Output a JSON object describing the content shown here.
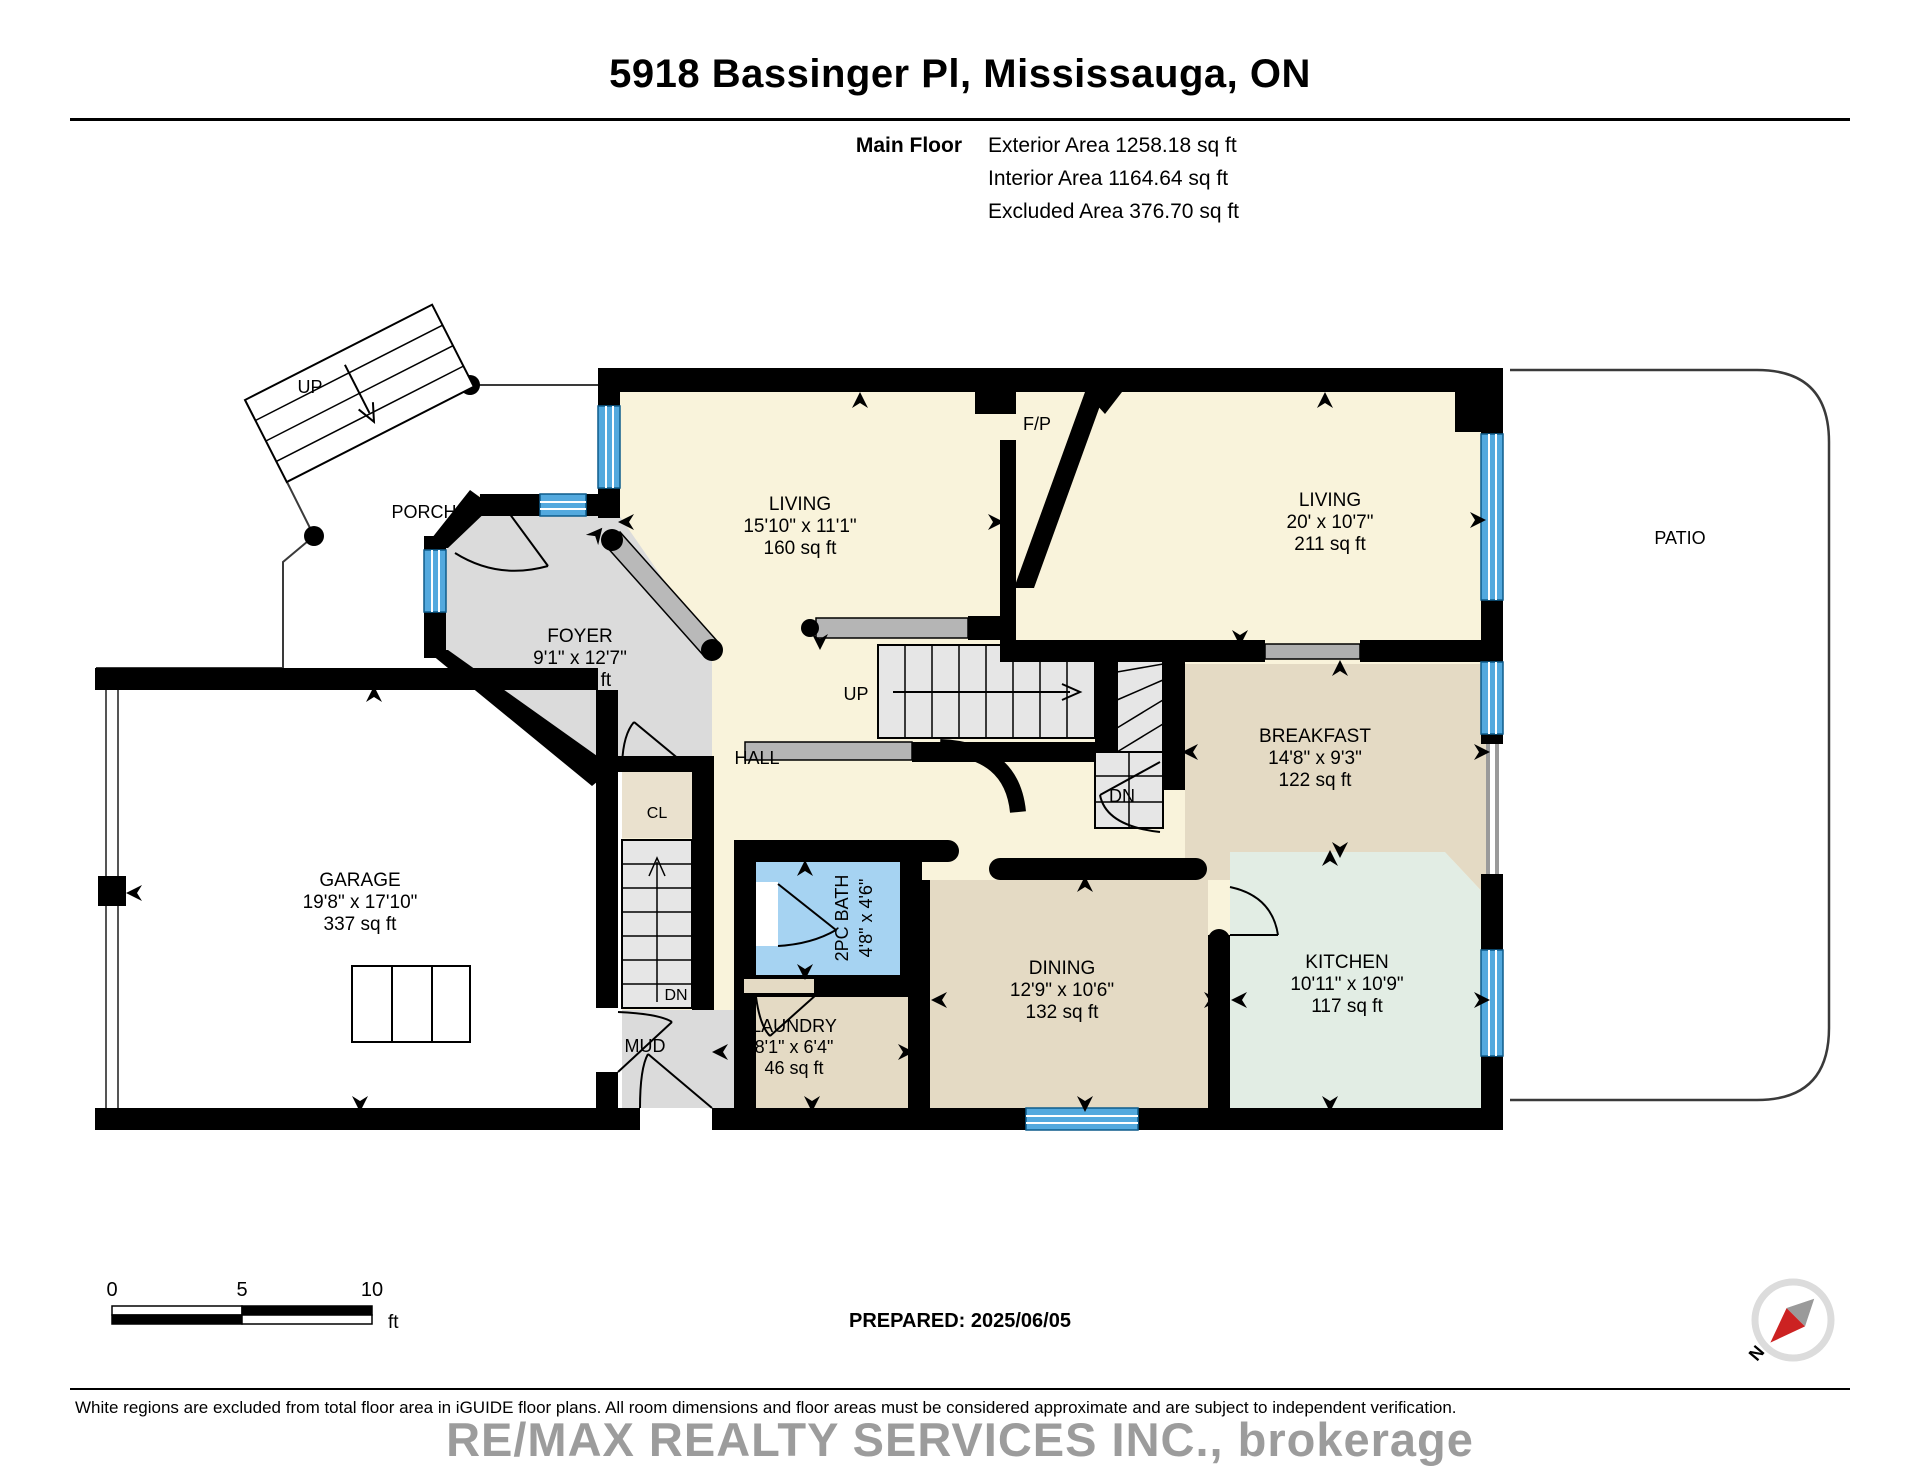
{
  "header": {
    "title": "5918 Bassinger Pl, Mississauga, ON",
    "floor_label": "Main Floor",
    "exterior": "Exterior Area 1258.18 sq ft",
    "interior": "Interior Area 1164.64 sq ft",
    "excluded": "Excluded Area 376.70 sq ft"
  },
  "rooms": {
    "living1": {
      "name": "LIVING",
      "dims": "15'10\" x 11'1\"",
      "area": "160 sq ft"
    },
    "living2": {
      "name": "LIVING",
      "dims": "20' x 10'7\"",
      "area": "211 sq ft"
    },
    "breakfast": {
      "name": "BREAKFAST",
      "dims": "14'8\" x 9'3\"",
      "area": "122 sq ft"
    },
    "kitchen": {
      "name": "KITCHEN",
      "dims": "10'11\" x 10'9\"",
      "area": "117 sq ft"
    },
    "dining": {
      "name": "DINING",
      "dims": "12'9\" x 10'6\"",
      "area": "132 sq ft"
    },
    "laundry": {
      "name": "LAUNDRY",
      "dims": "8'1\" x 6'4\"",
      "area": "46 sq ft"
    },
    "garage": {
      "name": "GARAGE",
      "dims": "19'8\" x 17'10\"",
      "area": "337 sq ft"
    },
    "foyer": {
      "name": "FOYER",
      "dims": "9'1\" x 12'7\"",
      "area": "76 sq ft"
    },
    "bath": {
      "name": "2PC BATH",
      "dims": "4'8\" x 4'6\""
    }
  },
  "labels": {
    "porch": "PORCH",
    "patio": "PATIO",
    "hall": "HALL",
    "mud": "MUD",
    "closet": "CL",
    "fireplace": "F/P",
    "up_porch": "UP",
    "up_stairs": "UP",
    "dn_basement": "DN",
    "dn_breakfast": "DN",
    "north": "N"
  },
  "scale_bar": {
    "zero": "0",
    "five": "5",
    "ten": "10",
    "unit": "ft"
  },
  "footer": {
    "prepared": "PREPARED: 2025/06/05",
    "disclaimer": "White regions are excluded from total floor area in iGUIDE floor plans. All room dimensions and floor areas must be considered approximate and are subject to independent verification.",
    "watermark": "RE/MAX REALTY SERVICES INC., brokerage"
  },
  "colors": {
    "wall": "#000000",
    "room_cream": "#F9F3DB",
    "room_tan": "#E4DAC4",
    "room_tan_light": "#EAE1CE",
    "room_mint": "#E2EDE4",
    "room_gray": "#DBDBDB",
    "stair_gray": "#E6E6E6",
    "bath_blue": "#A6D3F2",
    "window_blue": "#53A9DE",
    "slider_gray": "#AFAFAF",
    "compass_red": "#CC2222"
  }
}
